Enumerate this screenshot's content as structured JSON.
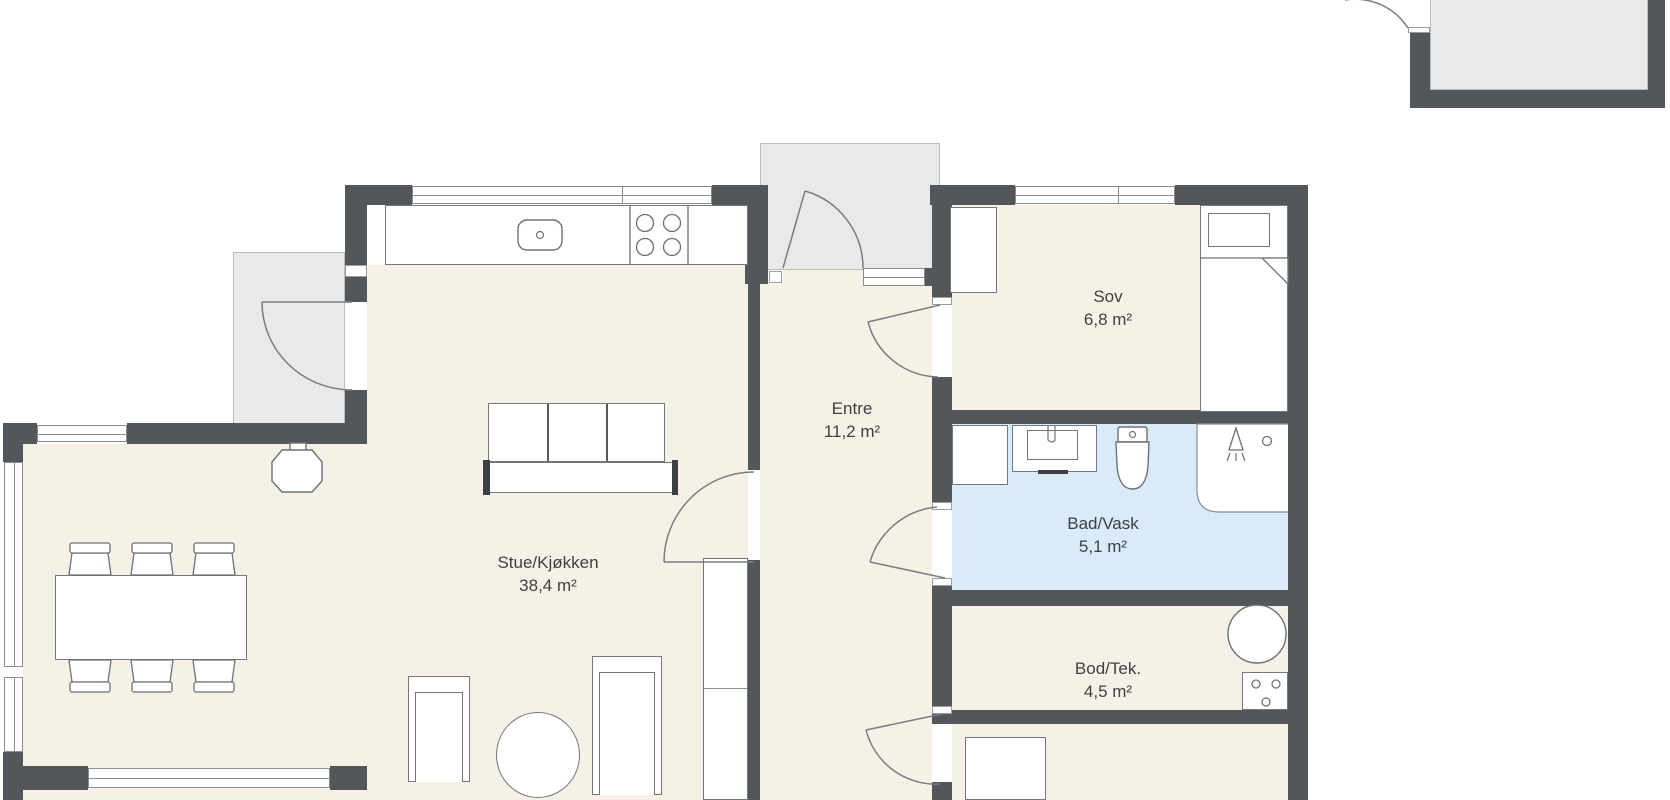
{
  "floorplan": {
    "rooms": [
      {
        "id": "stue",
        "name": "Stue/Kjøkken",
        "area": "38,4 m²"
      },
      {
        "id": "entre",
        "name": "Entre",
        "area": "11,2 m²"
      },
      {
        "id": "sov",
        "name": "Sov",
        "area": "6,8 m²"
      },
      {
        "id": "bad",
        "name": "Bad/Vask",
        "area": "5,1 m²"
      },
      {
        "id": "bod",
        "name": "Bod/Tek.",
        "area": "4,5 m²"
      }
    ],
    "colors": {
      "wall": "#53565b",
      "floor": "#f6f1e6",
      "bathroom_floor": "#d9eaf8",
      "outdoor": "#e9e9e9",
      "furniture_outline": "#73767a",
      "label_text": "#3e4043"
    }
  }
}
